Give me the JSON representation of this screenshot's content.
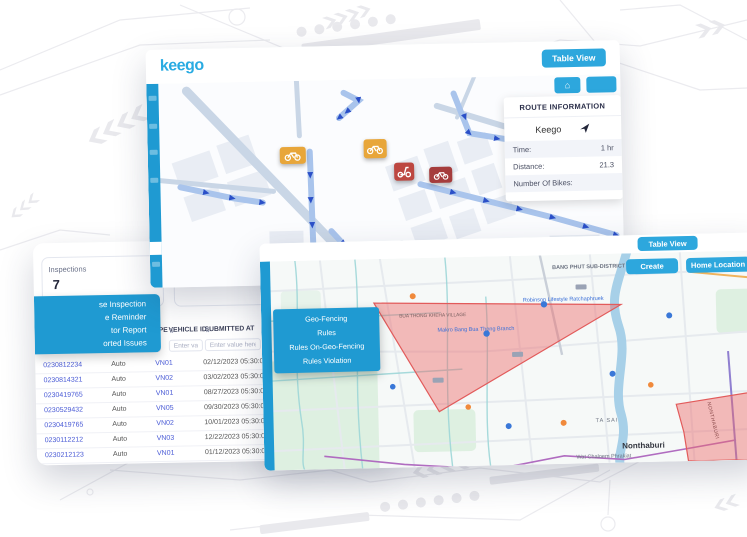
{
  "brand": {
    "logo_text": "keego"
  },
  "colors": {
    "brand_blue": "#29abe2",
    "sidebar_blue": "#1f9ad2",
    "button_blue": "#2da7dd",
    "route_blue": "#2b50c8",
    "geofence_red": "#e25b5b",
    "link_blue": "#4a5bd6"
  },
  "route_screen": {
    "table_view_button": "Table View",
    "route_info": {
      "title": "ROUTE INFORMATION",
      "provider": "Keego",
      "time_label": "Time:",
      "time_value": "1 hr",
      "distance_label": "Distance:",
      "distance_value": "21.3",
      "bikes_label": "Number Of Bikes:",
      "bikes_value": ""
    }
  },
  "inspections_screen": {
    "stat_card_1": {
      "label": "Inspections",
      "value": "7"
    },
    "stat_card_2": {
      "value": "7"
    },
    "menu_items": [
      {
        "label": "se Inspection"
      },
      {
        "label": "e Reminder"
      },
      {
        "label": "tor Report"
      },
      {
        "label": "orted Issues"
      }
    ],
    "table": {
      "sort_icon": "⇅",
      "col_inspection_type": "INSPECTION TYPE",
      "col_vehicle_id": "VEHICLE ID",
      "col_submitted_at": "SUBMITTED AT",
      "col_completed": "CO",
      "filter_1": "Enter value here",
      "filter_2": "Enter value l",
      "filter_3": "Enter value here",
      "filter_4": "Ente",
      "rows": [
        {
          "id": "0230812234",
          "type": "Auto",
          "vehicle": "VN01",
          "submitted": "02/12/2023 05:30:00 AM",
          "completed": "02/12"
        },
        {
          "id": "0230814321",
          "type": "Auto",
          "vehicle": "VN02",
          "submitted": "03/02/2023 05:30:00 AM",
          "completed": "03/04"
        },
        {
          "id": "0230419765",
          "type": "Auto",
          "vehicle": "VN01",
          "submitted": "08/27/2023 05:30:00 AM",
          "completed": "09/02"
        },
        {
          "id": "0230529432",
          "type": "Auto",
          "vehicle": "VN05",
          "submitted": "09/30/2023 05:30:00 AM",
          "completed": "10/03"
        },
        {
          "id": "0230419765",
          "type": "Auto",
          "vehicle": "VN02",
          "submitted": "10/01/2023 05:30:00 AM",
          "completed": "10/01"
        },
        {
          "id": "0230112212",
          "type": "Auto",
          "vehicle": "VN03",
          "submitted": "12/22/2023 05:30:00 AM",
          "completed": "12/22"
        },
        {
          "id": "0230212123",
          "type": "Auto",
          "vehicle": "VN01",
          "submitted": "01/12/2023 05:30:00 AM",
          "completed": "01/12"
        }
      ]
    }
  },
  "geofence_screen": {
    "table_view_button": "Table View",
    "create_button": "Create",
    "home_location_button": "Home Location",
    "menu_items": [
      {
        "label": "Geo-Fencing"
      },
      {
        "label": "Rules"
      },
      {
        "label": "Rules On-Geo-Fencing"
      },
      {
        "label": "Rules Violation"
      }
    ],
    "map_labels": {
      "district": "BANG PHUT SUB-DISTRICT",
      "poi_1": "Robinson Lifestyle Ratchaphruek",
      "poi_2": "Makro Bang Bua Thong Branch",
      "village": "BUA THONG KHEHA VILLAGE",
      "area_1": "TA SAI",
      "city": "Nonthaburi",
      "poi_3": "Wat Chaloem Phrakiat",
      "road_vertical": "NONTHABURI"
    }
  }
}
